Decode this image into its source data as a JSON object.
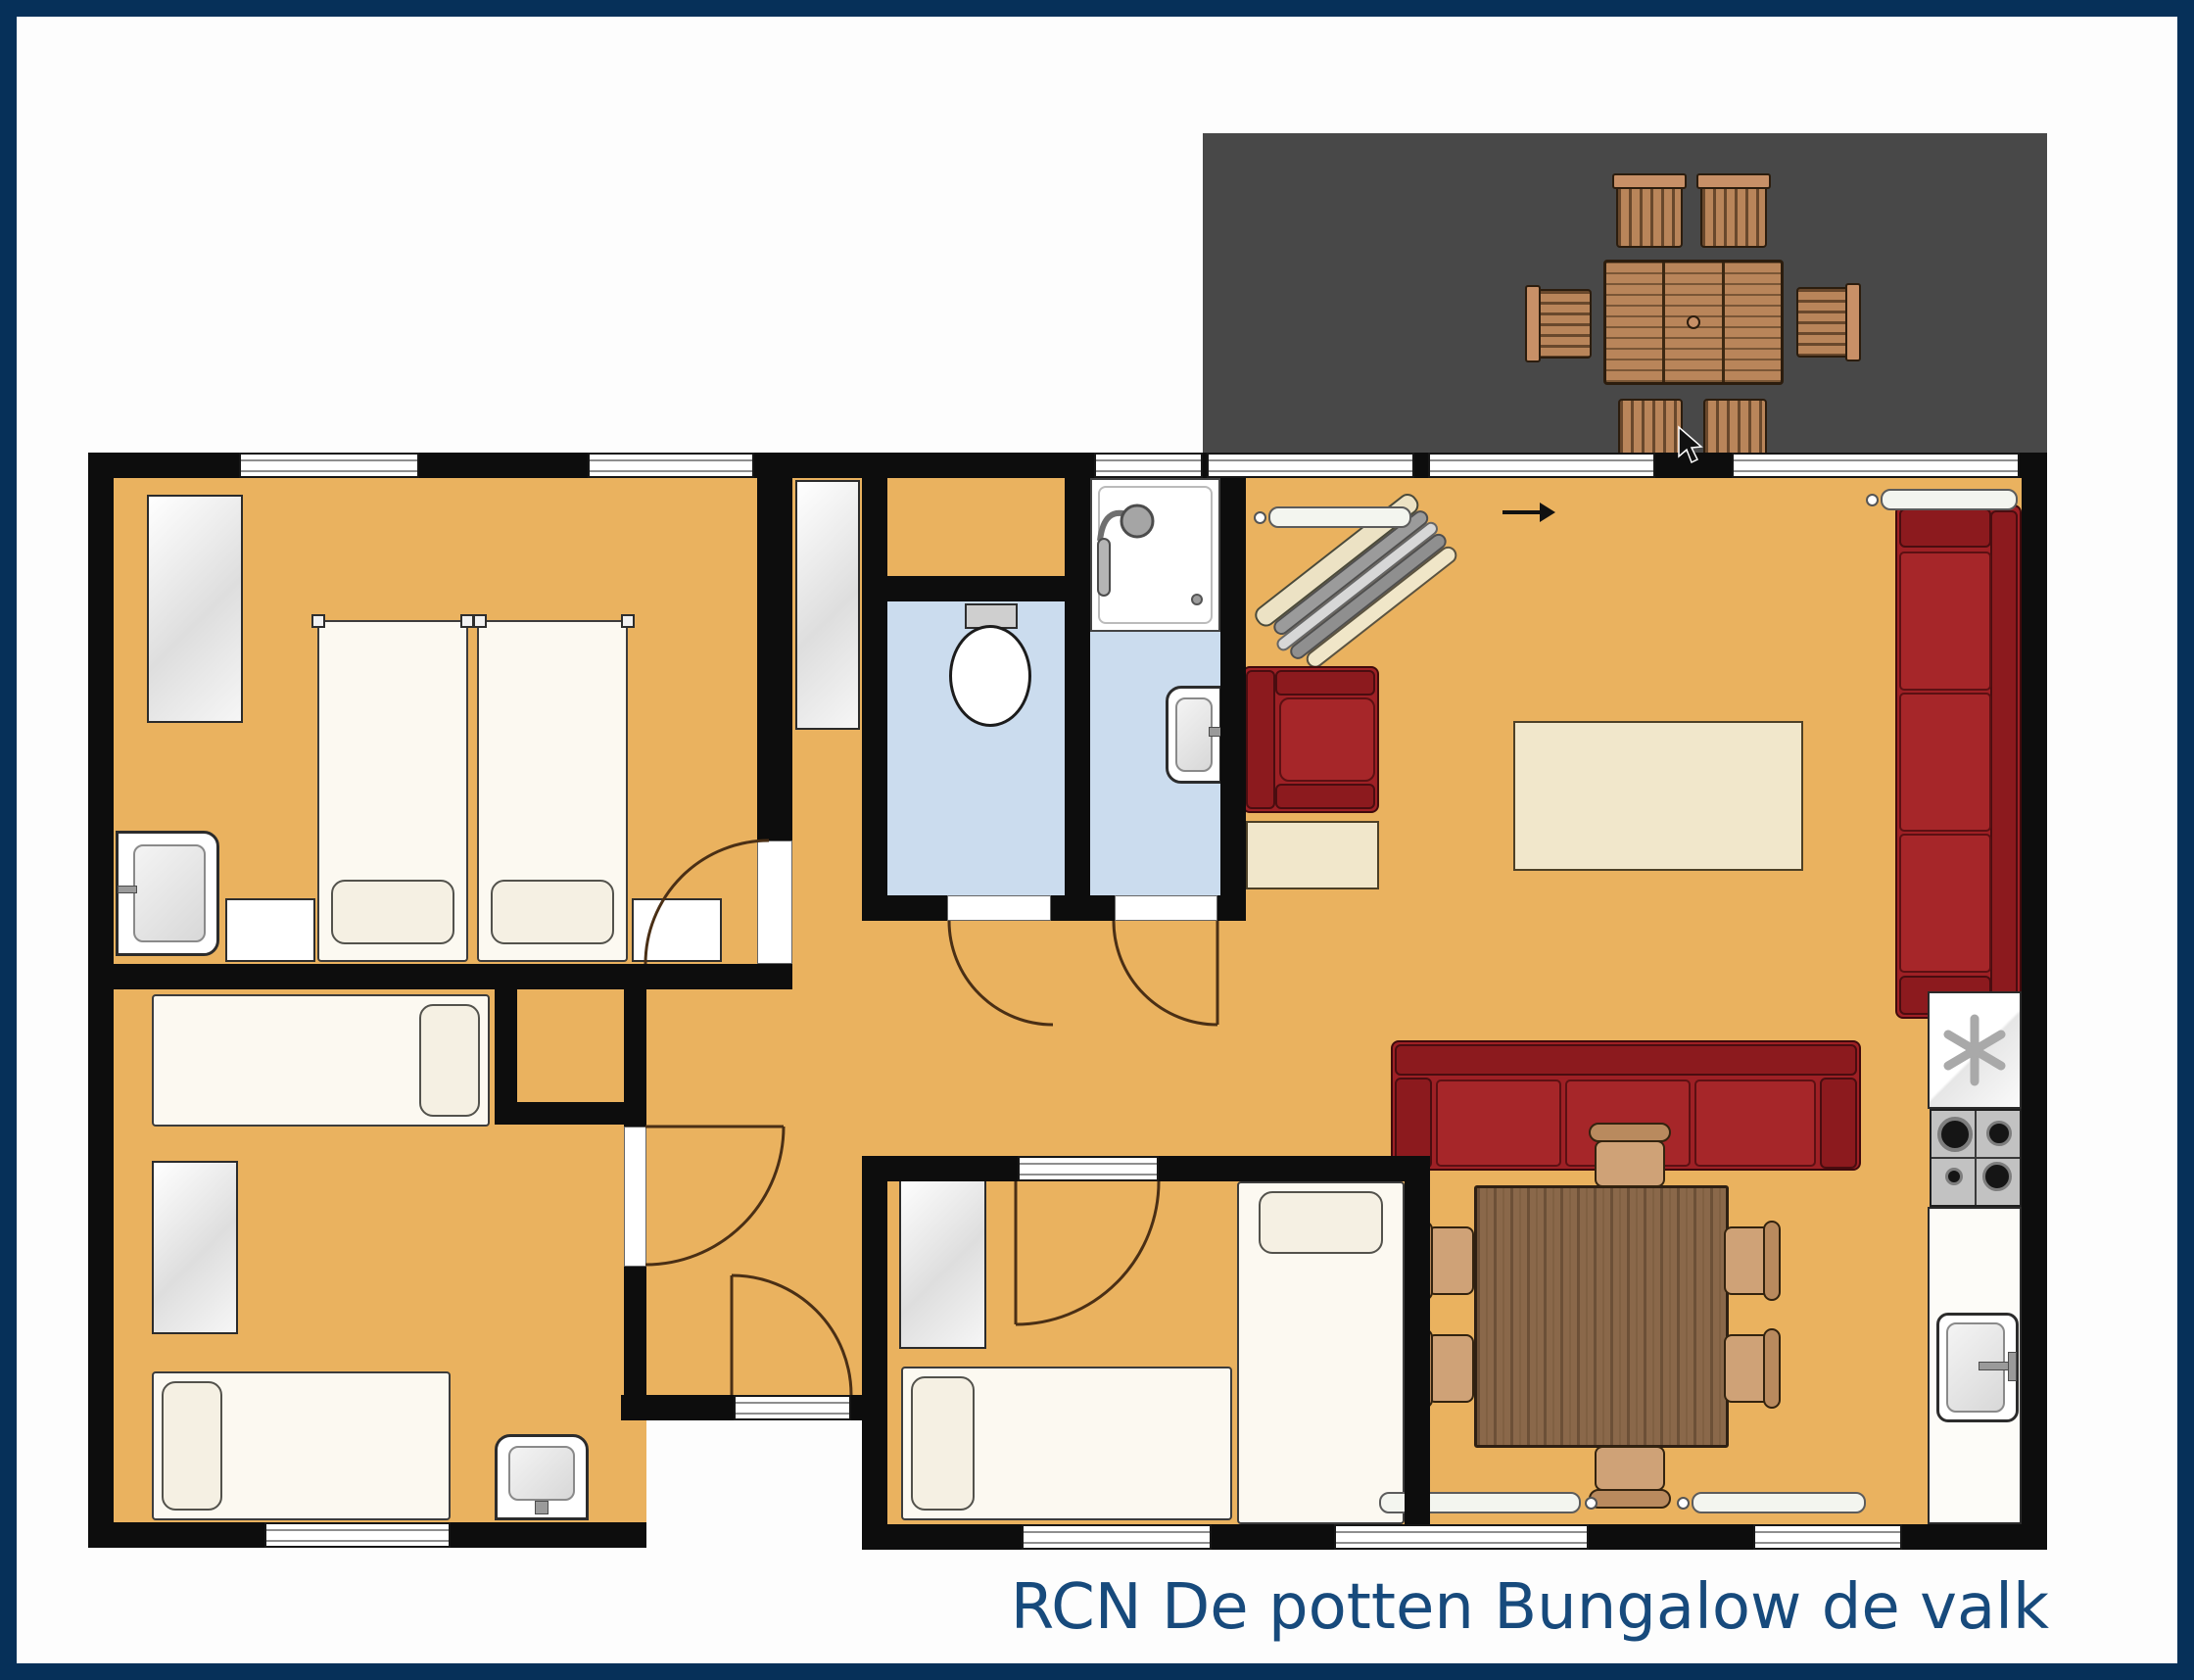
{
  "title": {
    "text": "RCN De potten Bungalow de valk"
  },
  "colors": {
    "frame_navy": "#063059",
    "title_text": "#174a7c",
    "wall_black": "#0d0d0d",
    "floor_orange": "#eab25f",
    "wet_room_blue": "#cbdcee",
    "terrace_gray": "#484848",
    "sofa_red": "#9e2025",
    "outdoor_wood": "#b9855a",
    "dining_wood": "#8a684a",
    "chair_tan": "#cfa277",
    "cream_furniture": "#f1e7cb"
  },
  "terrace": {
    "name": "terrace",
    "furniture": [
      "outdoor-dining-table",
      "outdoor-chair-north-1",
      "outdoor-chair-north-2",
      "outdoor-chair-south-1",
      "outdoor-chair-south-2",
      "outdoor-chair-west",
      "outdoor-chair-east"
    ]
  },
  "rooms": [
    {
      "name": "living-dining-kitchen",
      "furniture": [
        "sofa-three-seat-right-wall",
        "sofa-three-seat-horizontal",
        "armchair",
        "side-table",
        "coffee-table",
        "storage-rack-diagonal",
        "dining-table",
        "dining-chair x6",
        "fridge-freezer",
        "gas-stove",
        "kitchen-counter",
        "kitchen-sink",
        "radiator x4"
      ]
    },
    {
      "name": "bedroom-top-left",
      "furniture": [
        "single-bed x2",
        "pillow x2",
        "nightstand x2",
        "wardrobe",
        "washbasin"
      ]
    },
    {
      "name": "bedroom-bottom-left",
      "furniture": [
        "single-bed x2",
        "pillow x2",
        "wardrobe",
        "washbasin",
        "storage-niche"
      ]
    },
    {
      "name": "bedroom-bottom-middle",
      "furniture": [
        "single-bed x2",
        "pillow x2",
        "wardrobe"
      ]
    },
    {
      "name": "shower-room",
      "furniture": [
        "shower-tray",
        "shower-head",
        "washbasin"
      ]
    },
    {
      "name": "toilet-room",
      "furniture": [
        "toilet"
      ]
    },
    {
      "name": "hallway",
      "furniture": [
        "hall-closet",
        "back-door"
      ]
    }
  ],
  "annotations": {
    "entrance_arrow": "right-pointing arrow at terrace sliding door",
    "cursor": "mouse pointer captured on terrace",
    "doors_with_swing_arcs": 6,
    "windows": 10
  }
}
